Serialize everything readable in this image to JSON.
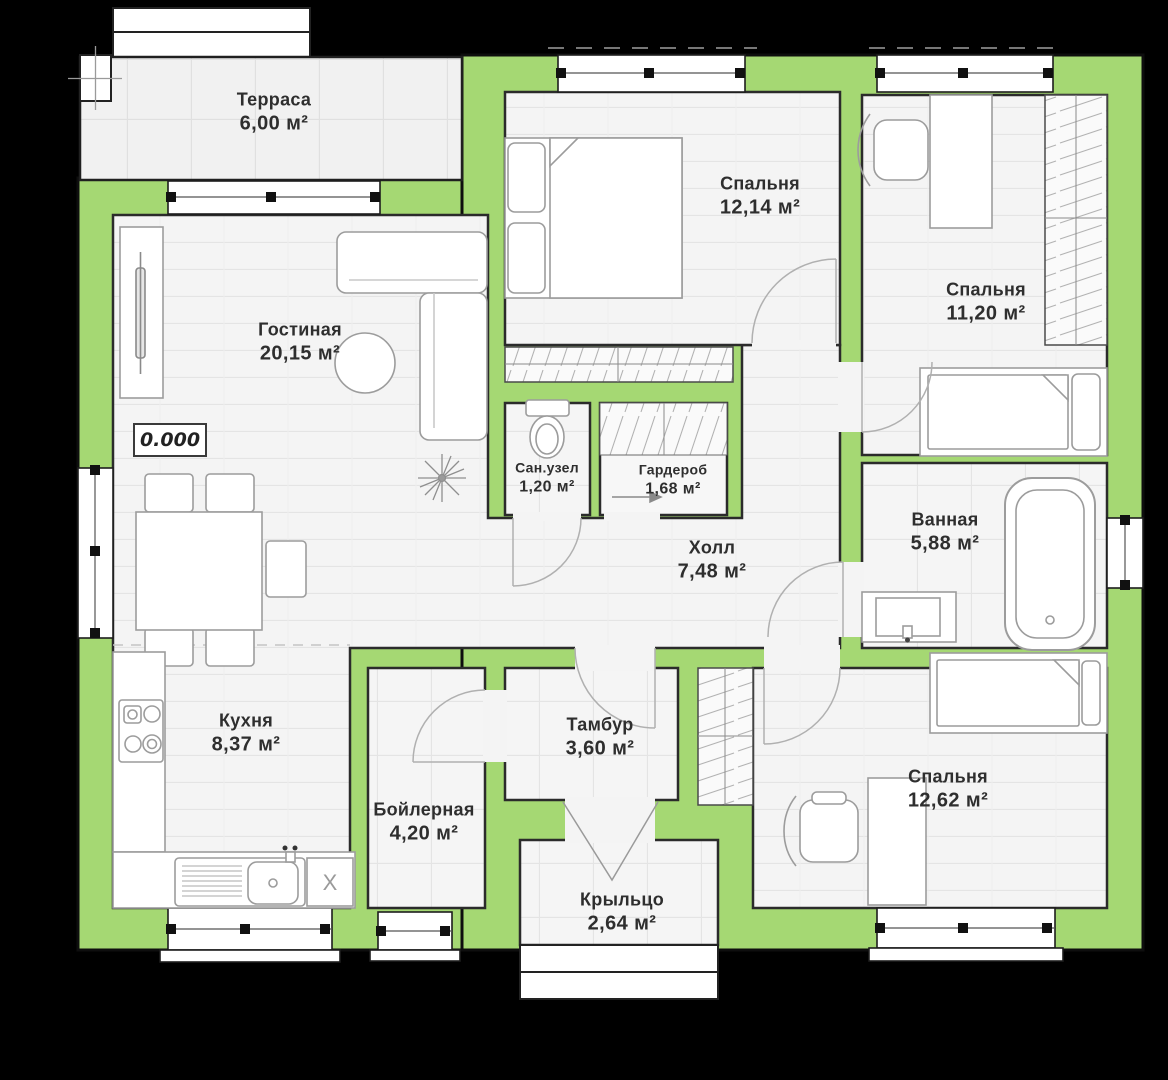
{
  "plan_title": "house-floor-plan",
  "rooms": {
    "terrace": {
      "name": "Терраса",
      "area": "6,00 м²"
    },
    "living": {
      "name": "Гостиная",
      "area": "20,15 м²"
    },
    "bedroom1": {
      "name": "Спальня",
      "area": "12,14 м²"
    },
    "bedroom2": {
      "name": "Спальня",
      "area": "11,20 м²"
    },
    "wc": {
      "name": "Сан.узел",
      "area": "1,20 м²"
    },
    "wardrobe": {
      "name": "Гардероб",
      "area": "1,68 м²"
    },
    "hall": {
      "name": "Холл",
      "area": "7,48 м²"
    },
    "bathroom": {
      "name": "Ванная",
      "area": "5,88 м²"
    },
    "kitchen": {
      "name": "Кухня",
      "area": "8,37 м²"
    },
    "boiler": {
      "name": "Бойлерная",
      "area": "4,20 м²"
    },
    "vestibule": {
      "name": "Тамбур",
      "area": "3,60 м²"
    },
    "porch": {
      "name": "Крыльцо",
      "area": "2,64 м²"
    },
    "bedroom3": {
      "name": "Спальня",
      "area": "12,62 м²"
    }
  },
  "markers": {
    "elevation": "0.000",
    "appliance": "X"
  },
  "colors": {
    "wall_fill": "#a5d873",
    "wall_line": "#141414",
    "floor": "#f4f4f4",
    "background": "#000000"
  }
}
